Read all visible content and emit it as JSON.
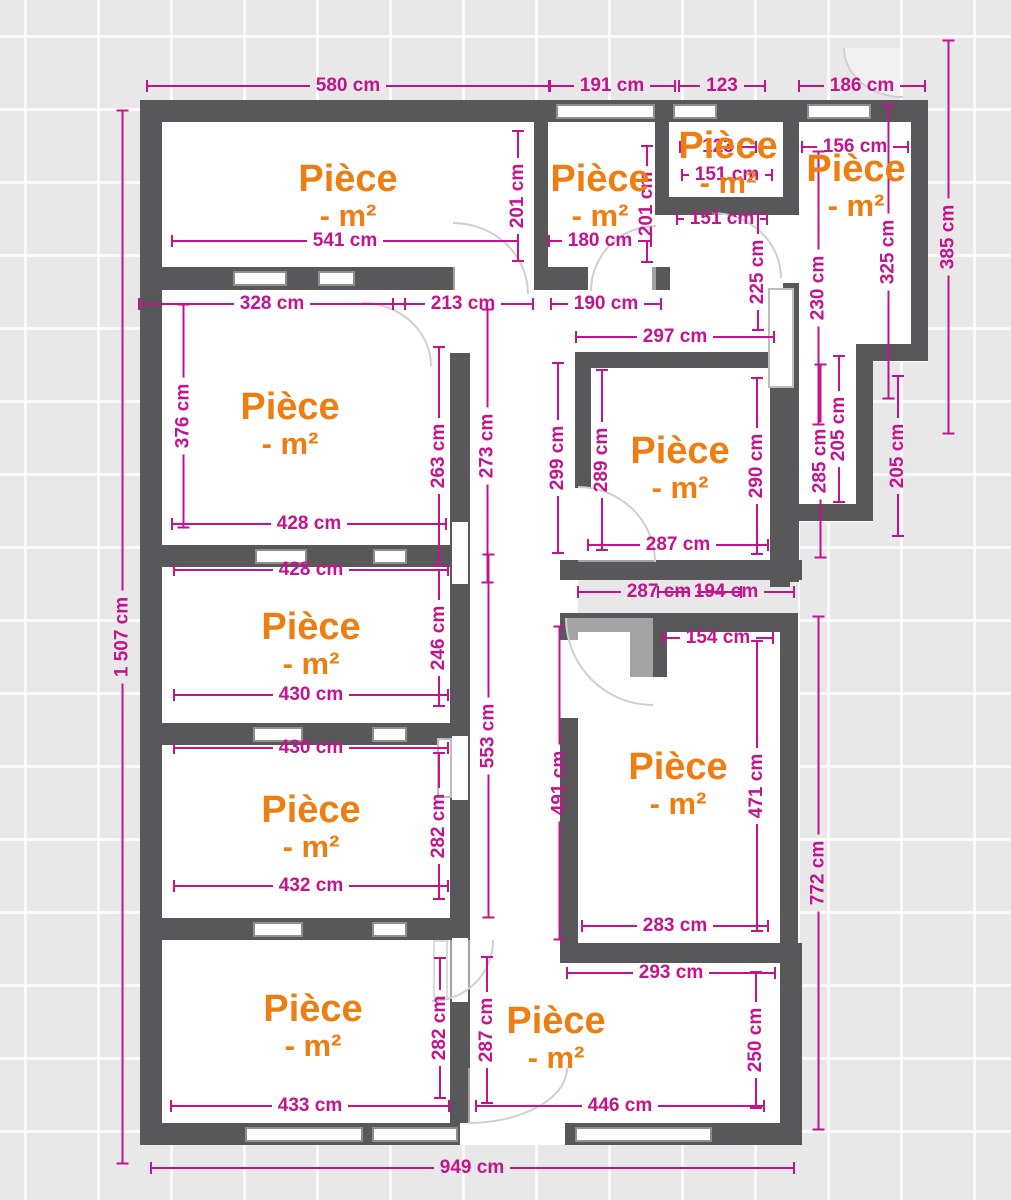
{
  "plan": {
    "unit": "cm",
    "colors": {
      "wall": "#58585a",
      "dimension_text": "#c4138e",
      "room_text": "#ee7e12",
      "background": "#e9e8e8",
      "room_fill": "#ffffff"
    },
    "rooms": [
      {
        "line1": "Pièce",
        "line2": "- m²",
        "x": 348,
        "y": 196
      },
      {
        "line1": "Pièce",
        "line2": "- m²",
        "x": 600,
        "y": 196
      },
      {
        "line1": "Pièce",
        "line2": "- m²",
        "x": 728,
        "y": 163
      },
      {
        "line1": "Pièce",
        "line2": "- m²",
        "x": 856,
        "y": 186
      },
      {
        "line1": "Pièce",
        "line2": "- m²",
        "x": 290,
        "y": 424
      },
      {
        "line1": "Pièce",
        "line2": "- m²",
        "x": 680,
        "y": 468
      },
      {
        "line1": "Pièce",
        "line2": "- m²",
        "x": 311,
        "y": 644
      },
      {
        "line1": "Pièce",
        "line2": "- m²",
        "x": 311,
        "y": 827
      },
      {
        "line1": "Pièce",
        "line2": "- m²",
        "x": 313,
        "y": 1026
      },
      {
        "line1": "Pièce",
        "line2": "- m²",
        "x": 556,
        "y": 1038
      },
      {
        "line1": "Pièce",
        "line2": "- m²",
        "x": 678,
        "y": 784
      }
    ],
    "dimensions": [
      {
        "text": "580 cm",
        "x": 348,
        "y": 86,
        "orient": "h",
        "len": 405
      },
      {
        "text": "191 cm",
        "x": 612,
        "y": 86,
        "orient": "h",
        "len": 128
      },
      {
        "text": "123",
        "x": 722,
        "y": 86,
        "orient": "h",
        "len": 88
      },
      {
        "text": "186 cm",
        "x": 862,
        "y": 86,
        "orient": "h",
        "len": 128
      },
      {
        "text": "541 cm",
        "x": 345,
        "y": 241,
        "orient": "h",
        "len": 348
      },
      {
        "text": "180 cm",
        "x": 600,
        "y": 241,
        "orient": "h",
        "len": 104
      },
      {
        "text": "123",
        "x": 718,
        "y": 147,
        "orient": "h",
        "len": 78
      },
      {
        "text": "151 cm",
        "x": 727,
        "y": 175,
        "orient": "h",
        "len": 92
      },
      {
        "text": "151 cm",
        "x": 722,
        "y": 219,
        "orient": "h",
        "len": 92
      },
      {
        "text": "156 cm",
        "x": 855,
        "y": 147,
        "orient": "h",
        "len": 108
      },
      {
        "text": "328 cm",
        "x": 272,
        "y": 304,
        "orient": "h",
        "len": 268
      },
      {
        "text": "213 cm",
        "x": 463,
        "y": 304,
        "orient": "h",
        "len": 142
      },
      {
        "text": "190 cm",
        "x": 606,
        "y": 304,
        "orient": "h",
        "len": 112
      },
      {
        "text": "297 cm",
        "x": 675,
        "y": 337,
        "orient": "h",
        "len": 200
      },
      {
        "text": "428 cm",
        "x": 309,
        "y": 524,
        "orient": "h",
        "len": 276
      },
      {
        "text": "287 cm",
        "x": 678,
        "y": 545,
        "orient": "h",
        "len": 182
      },
      {
        "text": "428 cm",
        "x": 311,
        "y": 570,
        "orient": "h",
        "len": 276
      },
      {
        "text": "287 cm",
        "x": 659,
        "y": 592,
        "orient": "h",
        "len": 165
      },
      {
        "text": "194 cm",
        "x": 726,
        "y": 592,
        "orient": "h",
        "len": 138
      },
      {
        "text": "154 cm",
        "x": 718,
        "y": 638,
        "orient": "h",
        "len": 112
      },
      {
        "text": "430 cm",
        "x": 311,
        "y": 695,
        "orient": "h",
        "len": 276
      },
      {
        "text": "430 cm",
        "x": 311,
        "y": 748,
        "orient": "h",
        "len": 276
      },
      {
        "text": "432 cm",
        "x": 311,
        "y": 886,
        "orient": "h",
        "len": 276
      },
      {
        "text": "433 cm",
        "x": 310,
        "y": 1106,
        "orient": "h",
        "len": 280
      },
      {
        "text": "446 cm",
        "x": 620,
        "y": 1106,
        "orient": "h",
        "len": 290
      },
      {
        "text": "293 cm",
        "x": 671,
        "y": 973,
        "orient": "h",
        "len": 210
      },
      {
        "text": "283 cm",
        "x": 675,
        "y": 926,
        "orient": "h",
        "len": 188
      },
      {
        "text": "949 cm",
        "x": 472,
        "y": 1168,
        "orient": "h",
        "len": 645
      },
      {
        "text": "1 507 cm",
        "x": 122,
        "y": 637,
        "orient": "v",
        "len": 1055
      },
      {
        "text": "201 cm",
        "x": 518,
        "y": 196,
        "orient": "v",
        "len": 132
      },
      {
        "text": "201 cm",
        "x": 647,
        "y": 204,
        "orient": "v",
        "len": 118
      },
      {
        "text": "225 cm",
        "x": 758,
        "y": 272,
        "orient": "v",
        "len": 118
      },
      {
        "text": "230 cm",
        "x": 818,
        "y": 288,
        "orient": "v",
        "len": 275
      },
      {
        "text": "325 cm",
        "x": 888,
        "y": 252,
        "orient": "v",
        "len": 295
      },
      {
        "text": "385 cm",
        "x": 948,
        "y": 237,
        "orient": "v",
        "len": 395
      },
      {
        "text": "285 cm",
        "x": 820,
        "y": 461,
        "orient": "v",
        "len": 195
      },
      {
        "text": "205 cm",
        "x": 839,
        "y": 429,
        "orient": "v",
        "len": 148
      },
      {
        "text": "205 cm",
        "x": 898,
        "y": 456,
        "orient": "v",
        "len": 162
      },
      {
        "text": "376 cm",
        "x": 183,
        "y": 416,
        "orient": "v",
        "len": 225
      },
      {
        "text": "263 cm",
        "x": 439,
        "y": 456,
        "orient": "v",
        "len": 220
      },
      {
        "text": "273 cm",
        "x": 487,
        "y": 446,
        "orient": "v",
        "len": 275
      },
      {
        "text": "299 cm",
        "x": 558,
        "y": 458,
        "orient": "v",
        "len": 192
      },
      {
        "text": "289 cm",
        "x": 602,
        "y": 460,
        "orient": "v",
        "len": 182
      },
      {
        "text": "290 cm",
        "x": 757,
        "y": 466,
        "orient": "v",
        "len": 178
      },
      {
        "text": "246 cm",
        "x": 439,
        "y": 638,
        "orient": "v",
        "len": 138
      },
      {
        "text": "553 cm",
        "x": 488,
        "y": 736,
        "orient": "v",
        "len": 365
      },
      {
        "text": "282 cm",
        "x": 439,
        "y": 826,
        "orient": "v",
        "len": 148
      },
      {
        "text": "491 cm",
        "x": 559,
        "y": 783,
        "orient": "v",
        "len": 315
      },
      {
        "text": "471 cm",
        "x": 757,
        "y": 786,
        "orient": "v",
        "len": 292
      },
      {
        "text": "772 cm",
        "x": 818,
        "y": 873,
        "orient": "v",
        "len": 515
      },
      {
        "text": "282 cm",
        "x": 440,
        "y": 1028,
        "orient": "v",
        "len": 142
      },
      {
        "text": "287 cm",
        "x": 487,
        "y": 1030,
        "orient": "v",
        "len": 148
      },
      {
        "text": "250 cm",
        "x": 756,
        "y": 1040,
        "orient": "v",
        "len": 138
      }
    ]
  }
}
